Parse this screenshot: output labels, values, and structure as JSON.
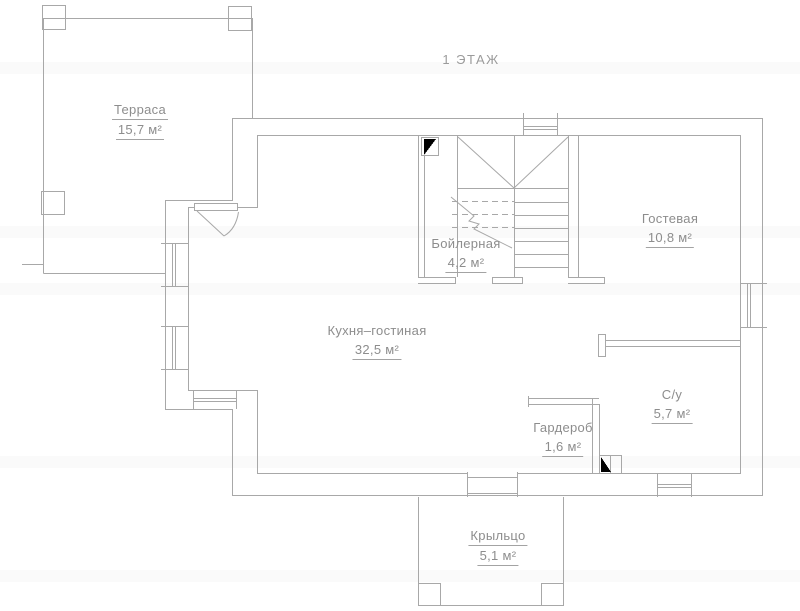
{
  "title": "1 ЭТАЖ",
  "rooms": [
    {
      "name": "Терраса",
      "area": "15,7 м²"
    },
    {
      "name": "Бойлерная",
      "area": "4,2 м²"
    },
    {
      "name": "Гостевая",
      "area": "10,8 м²"
    },
    {
      "name": "Кухня–гостиная",
      "area": "32,5 м²"
    },
    {
      "name": "С/у",
      "area": "5,7 м²"
    },
    {
      "name": "Гардероб",
      "area": "1,6 м²"
    },
    {
      "name": "Крыльцо",
      "area": "5,1 м²"
    }
  ],
  "colors": {
    "wall_line": "#a8a8a8",
    "label_text": "#8d8d8d",
    "door_marker": "#000000",
    "background": "#ffffff"
  }
}
